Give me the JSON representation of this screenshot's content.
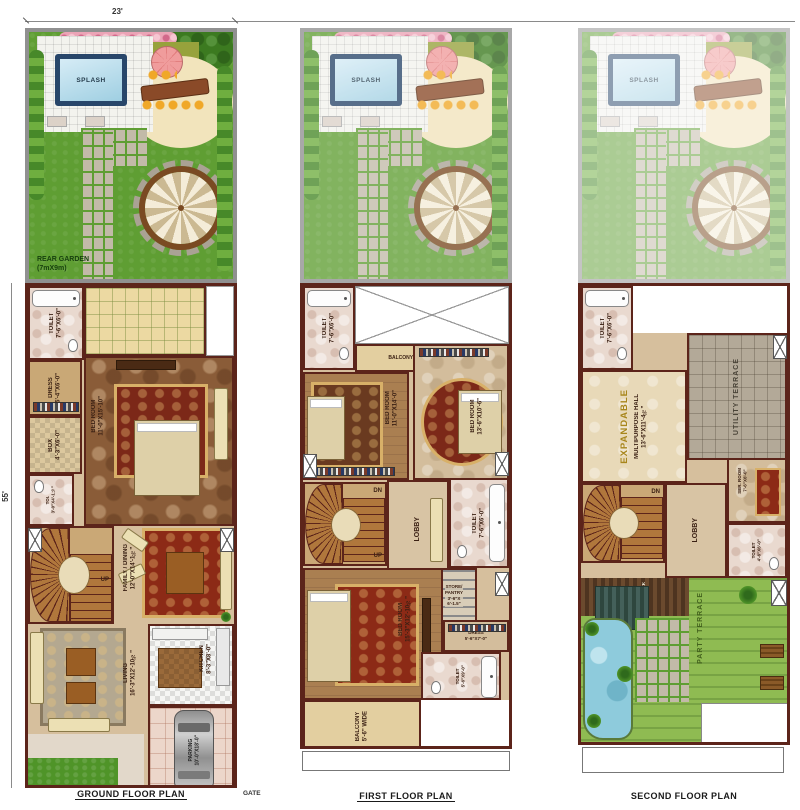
{
  "dimensions": {
    "top_width": "23'",
    "left_height": "55'"
  },
  "garden": {
    "splash": "SPLASH",
    "rear_garden": "REAR GARDEN\n(7mX9m)"
  },
  "plans": [
    {
      "caption": "GROUND FLOOR PLAN",
      "gate_label": "GATE",
      "rooms": {
        "toilet": "TOILET\n7'-6\"X6'-0\"",
        "dress": "DRESS\n5'-4\"X6'-0\"",
        "box": "BOX\n4'-3\"X6'-0\"",
        "toi": "TOI.\n3'-0\"X4'-1½\"",
        "bedroom": "BED ROOM\n11'-0\"X15'-10\"",
        "family": "FAMILY / DINING\n12'-0\"X14'-1½\"",
        "up": "UP",
        "kitchen": "KITCHEN\n8'-3\"X8'-0\"",
        "living": "LIVING\n16'-3\"X12'-10½\"",
        "parking": "PARKING\n10'-0\"X18'-0\""
      }
    },
    {
      "caption": "FIRST FLOOR PLAN",
      "rooms": {
        "toilet_top": "TOILET\n7'-6\"X6'-0\"",
        "balcony_top": "BALCONY 3'-3\" WIDE",
        "bedroom_left": "BED ROOM\n11'-0\"X14'-0\"",
        "bedroom_right": "BED ROOM\n13'-6\"X10'-6\"",
        "dn": "DN",
        "up": "UP",
        "lobby": "LOBBY",
        "toilet_mid": "TOILET\n7'-6\"X6'-0\"",
        "store": "STORE/\nPANTRY\n3'-6\"X\n6'-1.5\"",
        "bedroom_bottom": "BED ROOM\n15'-3\"X12'-10½\"",
        "dress": "DRESS\n5'-6\"X7'-0\"",
        "toilet_bottom": "TOILET\n5'-6\"X9'-0\"",
        "balcony_bottom": "BALCONY\n5'-6\" WIDE"
      }
    },
    {
      "caption": "SECOND FLOOR PLAN",
      "rooms": {
        "toilet_top": "TOILET\n7'-6\"X6'-0\"",
        "expandable": "EXPANDABLE",
        "hall": "MULTIPURPOSE HALL\n13'-6\"X11'-4½\"",
        "utility": "UTILITY TERRACE",
        "dn": "DN",
        "lobby": "LOBBY",
        "ser_room": "SER. ROOM\n7'-6\"X6'-0\"",
        "toilet_mid": "TOILET\n4'-6\"X6'-0\"",
        "wood_deck": "WOOD DECK",
        "party": "PARTY TERRACE"
      }
    }
  ],
  "colors": {
    "wall": "#5c241a",
    "floor_beige": "#d6bf9d",
    "grass": "#5f9e33",
    "pool_water": "#bfe0ee",
    "terrace_paver": "#b3a998",
    "rug_red": "#8c2a16",
    "umbrella_pink": "#ef9e9e",
    "lawn_terrace": "#8fbb52"
  }
}
